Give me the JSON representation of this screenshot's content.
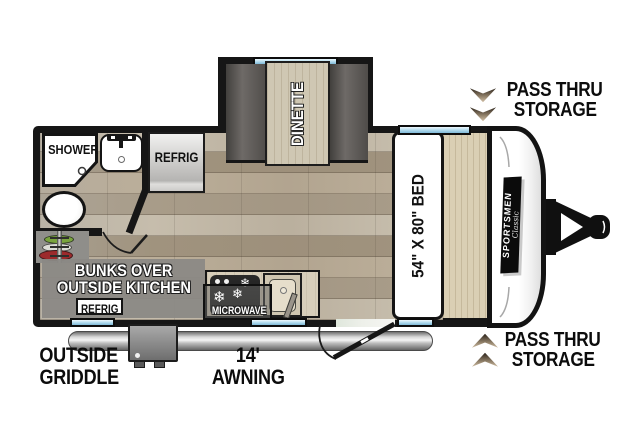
{
  "rooms": {
    "dinette": {
      "label": "DINETTE"
    },
    "bathroom": {
      "shower_label": "SHOWER"
    },
    "kitchen": {
      "refrig_label": "REFRIG",
      "microwave_label": "MICROWAVE"
    },
    "bedroom": {
      "bed_label": "54\" X 80\" BED"
    },
    "bunks": {
      "line1": "BUNKS OVER",
      "line2": "OUTSIDE KITCHEN",
      "refrig_label": "REFRIG"
    }
  },
  "exterior": {
    "brand": "SPORTSMEN",
    "brand_series": "Classic",
    "pass_thru_top": {
      "line1": "PASS THRU",
      "line2": "STORAGE"
    },
    "pass_thru_bottom": {
      "line1": "PASS THRU",
      "line2": "STORAGE"
    },
    "outside_griddle": {
      "line1": "OUTSIDE",
      "line2": "GRIDDLE"
    },
    "awning": {
      "line1": "14'",
      "line2": "AWNING"
    }
  },
  "icons": {
    "burner_star": "❄"
  },
  "colors": {
    "wall": "#161616",
    "window_blue": "#a9d6ec",
    "floor_wood": "#b2a793",
    "overlay_gray": "#8b8985",
    "arrow_dark": "#1f1811",
    "arrow_light": "#dccab0"
  }
}
